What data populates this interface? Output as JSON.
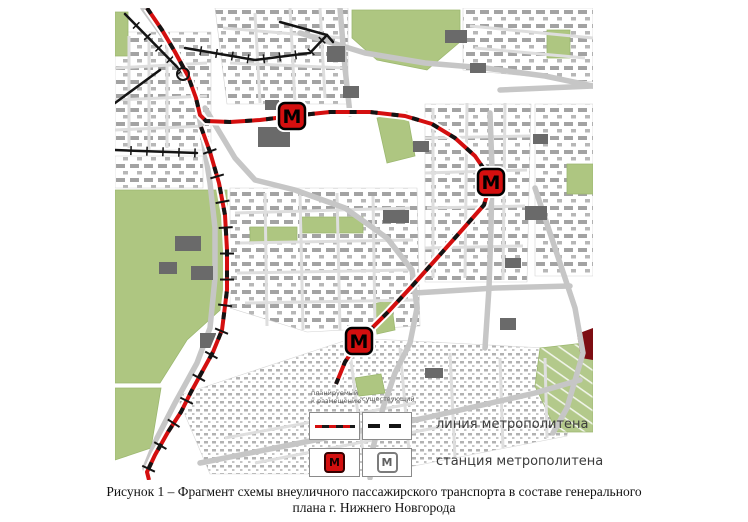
{
  "figure": {
    "caption_line1": "Рисунок 1 – Фрагмент схемы внеуличного пассажирского транспорта в составе генерального",
    "caption_line2": "плана г. Нижнего Новгорода"
  },
  "legend": {
    "header1_line1": "планируемый",
    "header1_line2": "к размещению",
    "header2": "существующий",
    "row1_label": "линия метрополитена",
    "row2_label": "станция метрополитена",
    "station_letter": "М"
  },
  "colors": {
    "metro_red": "#d40f0f",
    "line_black": "#141414",
    "park_green": "#aec681",
    "allotment_green": "#b3c98b",
    "road_gray": "#c6c6c6",
    "minor_road_gray": "#dedede",
    "dark_building": "#6a6a6a",
    "dark_red_area": "#7d0d12"
  },
  "map": {
    "stations_planned": [
      [
        177,
        108
      ],
      [
        376,
        174
      ],
      [
        244,
        333
      ]
    ],
    "metro_line_planned": [
      [
        32,
        0
      ],
      [
        47,
        22
      ],
      [
        60,
        44
      ],
      [
        73,
        68
      ],
      [
        81,
        90
      ],
      [
        85,
        107
      ],
      [
        91,
        113
      ],
      [
        115,
        114
      ],
      [
        145,
        112
      ],
      [
        177,
        108
      ],
      [
        215,
        104
      ],
      [
        255,
        104
      ],
      [
        290,
        108
      ],
      [
        317,
        116
      ],
      [
        340,
        130
      ],
      [
        360,
        148
      ],
      [
        369,
        161
      ],
      [
        376,
        174
      ],
      [
        369,
        197
      ],
      [
        347,
        222
      ],
      [
        323,
        249
      ],
      [
        298,
        277
      ],
      [
        273,
        304
      ],
      [
        244,
        333
      ],
      [
        230,
        354
      ],
      [
        221,
        376
      ]
    ],
    "railway_red": [
      [
        86,
        119
      ],
      [
        95,
        144
      ],
      [
        104,
        175
      ],
      [
        110,
        207
      ],
      [
        112,
        242
      ],
      [
        112,
        282
      ],
      [
        107,
        322
      ],
      [
        98,
        344
      ],
      [
        87,
        364
      ],
      [
        76,
        384
      ],
      [
        66,
        404
      ],
      [
        53,
        424
      ],
      [
        40,
        447
      ],
      [
        32,
        464
      ],
      [
        34,
        472
      ]
    ],
    "railways_black": [
      {
        "pts": [
          [
            10,
            6
          ],
          [
            71,
            68
          ]
        ],
        "ticks": true
      },
      {
        "pts": [
          [
            0,
            142
          ],
          [
            82,
            145
          ]
        ],
        "ticks": true
      },
      {
        "pts": [
          [
            45,
            62
          ],
          [
            0,
            95
          ]
        ],
        "ticks": false
      },
      {
        "pts": [
          [
            70,
            40
          ],
          [
            140,
            52
          ],
          [
            195,
            45
          ],
          [
            212,
            27
          ]
        ],
        "ticks": true
      },
      {
        "pts": [
          [
            165,
            14
          ],
          [
            212,
            27
          ],
          [
            218,
            34
          ]
        ],
        "ticks": false
      }
    ],
    "junction_circle": [
      68,
      66,
      6
    ],
    "parks": [
      [
        [
          0,
          4
        ],
        [
          13,
          4
        ],
        [
          13,
          48
        ],
        [
          0,
          48
        ]
      ],
      [
        [
          237,
          2
        ],
        [
          345,
          2
        ],
        [
          345,
          34
        ],
        [
          312,
          62
        ],
        [
          262,
          52
        ],
        [
          237,
          30
        ]
      ],
      [
        [
          432,
          22
        ],
        [
          455,
          22
        ],
        [
          455,
          50
        ],
        [
          432,
          50
        ]
      ],
      [
        [
          452,
          156
        ],
        [
          478,
          156
        ],
        [
          478,
          186
        ],
        [
          452,
          186
        ]
      ],
      [
        [
          0,
          182
        ],
        [
          112,
          182
        ],
        [
          113,
          295
        ],
        [
          72,
          332
        ],
        [
          45,
          375
        ],
        [
          0,
          375
        ]
      ],
      [
        [
          0,
          380
        ],
        [
          46,
          380
        ],
        [
          36,
          440
        ],
        [
          0,
          452
        ]
      ],
      [
        [
          135,
          219
        ],
        [
          182,
          219
        ],
        [
          182,
          234
        ],
        [
          135,
          234
        ]
      ],
      [
        [
          187,
          209
        ],
        [
          248,
          209
        ],
        [
          248,
          225
        ],
        [
          187,
          225
        ]
      ],
      [
        [
          262,
          110
        ],
        [
          292,
          104
        ],
        [
          300,
          148
        ],
        [
          272,
          155
        ]
      ],
      [
        [
          258,
          296
        ],
        [
          276,
          292
        ],
        [
          280,
          322
        ],
        [
          262,
          326
        ]
      ],
      [
        [
          240,
          370
        ],
        [
          266,
          366
        ],
        [
          270,
          385
        ],
        [
          244,
          388
        ]
      ]
    ],
    "allotment": [
      [
        425,
        340
      ],
      [
        478,
        334
      ],
      [
        478,
        424
      ],
      [
        442,
        424
      ],
      [
        420,
        378
      ]
    ],
    "dark_red_poly": [
      [
        462,
        326
      ],
      [
        478,
        320
      ],
      [
        478,
        352
      ],
      [
        466,
        350
      ]
    ],
    "fabric_coarse": [
      [
        [
          0,
          24
        ],
        [
          96,
          24
        ],
        [
          96,
          142
        ],
        [
          0,
          142
        ]
      ],
      [
        [
          100,
          0
        ],
        [
          233,
          0
        ],
        [
          233,
          96
        ],
        [
          112,
          96
        ]
      ],
      [
        [
          348,
          0
        ],
        [
          478,
          0
        ],
        [
          478,
          74
        ],
        [
          348,
          62
        ]
      ],
      [
        [
          420,
          96
        ],
        [
          478,
          96
        ],
        [
          478,
          268
        ],
        [
          420,
          268
        ]
      ],
      [
        [
          115,
          180
        ],
        [
          302,
          180
        ],
        [
          305,
          318
        ],
        [
          192,
          324
        ],
        [
          115,
          300
        ]
      ],
      [
        [
          310,
          96
        ],
        [
          416,
          96
        ],
        [
          412,
          274
        ],
        [
          310,
          274
        ]
      ],
      [
        [
          0,
          148
        ],
        [
          88,
          148
        ],
        [
          88,
          180
        ],
        [
          0,
          180
        ]
      ]
    ],
    "fabric_fine": [
      [
        [
          62,
          388
        ],
        [
          238,
          330
        ],
        [
          470,
          342
        ],
        [
          452,
          428
        ],
        [
          258,
          466
        ],
        [
          95,
          466
        ]
      ]
    ],
    "roads_major": [
      [
        [
          185,
          25
        ],
        [
          250,
          45
        ],
        [
          310,
          55
        ],
        [
          370,
          60
        ],
        [
          430,
          68
        ],
        [
          478,
          78
        ]
      ],
      [
        [
          28,
          0
        ],
        [
          60,
          44
        ],
        [
          81,
          90
        ],
        [
          88,
          130
        ],
        [
          95,
          175
        ],
        [
          100,
          220
        ],
        [
          100,
          270
        ],
        [
          95,
          320
        ],
        [
          82,
          355
        ],
        [
          60,
          395
        ],
        [
          42,
          430
        ],
        [
          30,
          460
        ],
        [
          33,
          472
        ]
      ],
      [
        [
          90,
          100
        ],
        [
          120,
          150
        ],
        [
          140,
          172
        ],
        [
          180,
          182
        ],
        [
          230,
          200
        ],
        [
          272,
          230
        ],
        [
          297,
          262
        ],
        [
          302,
          300
        ],
        [
          295,
          335
        ],
        [
          280,
          365
        ],
        [
          268,
          400
        ],
        [
          258,
          440
        ],
        [
          255,
          470
        ]
      ],
      [
        [
          375,
          105
        ],
        [
          377,
          160
        ],
        [
          376,
          220
        ],
        [
          374,
          280
        ],
        [
          370,
          340
        ]
      ],
      [
        [
          420,
          180
        ],
        [
          440,
          240
        ],
        [
          460,
          300
        ],
        [
          468,
          345
        ],
        [
          452,
          400
        ],
        [
          438,
          425
        ]
      ],
      [
        [
          300,
          285
        ],
        [
          380,
          280
        ],
        [
          455,
          278
        ]
      ],
      [
        [
          385,
          82
        ],
        [
          478,
          78
        ]
      ],
      [
        [
          85,
          455
        ],
        [
          200,
          432
        ],
        [
          310,
          410
        ],
        [
          420,
          385
        ],
        [
          465,
          372
        ]
      ],
      [
        [
          225,
          0
        ],
        [
          230,
          60
        ],
        [
          235,
          106
        ]
      ]
    ],
    "roads_minor": [
      [
        [
          14,
          28
        ],
        [
          14,
          140
        ]
      ],
      [
        [
          34,
          26
        ],
        [
          34,
          142
        ]
      ],
      [
        [
          52,
          30
        ],
        [
          52,
          140
        ]
      ],
      [
        [
          0,
          60
        ],
        [
          92,
          55
        ]
      ],
      [
        [
          0,
          92
        ],
        [
          92,
          88
        ]
      ],
      [
        [
          0,
          122
        ],
        [
          90,
          118
        ]
      ],
      [
        [
          108,
          20
        ],
        [
          228,
          30
        ]
      ],
      [
        [
          115,
          55
        ],
        [
          230,
          60
        ]
      ],
      [
        [
          140,
          5
        ],
        [
          145,
          95
        ]
      ],
      [
        [
          175,
          0
        ],
        [
          180,
          95
        ]
      ],
      [
        [
          205,
          0
        ],
        [
          210,
          90
        ]
      ],
      [
        [
          318,
          100
        ],
        [
          318,
          270
        ]
      ],
      [
        [
          352,
          95
        ],
        [
          350,
          270
        ]
      ],
      [
        [
          390,
          95
        ],
        [
          388,
          272
        ]
      ],
      [
        [
          310,
          130
        ],
        [
          415,
          128
        ]
      ],
      [
        [
          310,
          165
        ],
        [
          412,
          162
        ]
      ],
      [
        [
          312,
          200
        ],
        [
          410,
          198
        ]
      ],
      [
        [
          310,
          240
        ],
        [
          408,
          238
        ]
      ],
      [
        [
          120,
          205
        ],
        [
          295,
          200
        ]
      ],
      [
        [
          125,
          235
        ],
        [
          298,
          232
        ]
      ],
      [
        [
          122,
          265
        ],
        [
          296,
          262
        ]
      ],
      [
        [
          130,
          295
        ],
        [
          300,
          292
        ]
      ],
      [
        [
          150,
          185
        ],
        [
          152,
          318
        ]
      ],
      [
        [
          185,
          185
        ],
        [
          188,
          322
        ]
      ],
      [
        [
          222,
          185
        ],
        [
          225,
          322
        ]
      ],
      [
        [
          258,
          188
        ],
        [
          260,
          320
        ]
      ],
      [
        [
          110,
          430
        ],
        [
          300,
          395
        ]
      ],
      [
        [
          140,
          455
        ],
        [
          330,
          418
        ]
      ],
      [
        [
          235,
          345
        ],
        [
          250,
          460
        ]
      ],
      [
        [
          285,
          340
        ],
        [
          295,
          455
        ]
      ],
      [
        [
          335,
          345
        ],
        [
          340,
          450
        ]
      ],
      [
        [
          385,
          350
        ],
        [
          388,
          440
        ]
      ],
      [
        [
          430,
          350
        ],
        [
          432,
          430
        ]
      ],
      [
        [
          355,
          18
        ],
        [
          478,
          30
        ]
      ],
      [
        [
          360,
          40
        ],
        [
          470,
          50
        ]
      ]
    ],
    "dark_buildings": [
      [
        143,
        119,
        32,
        20
      ],
      [
        212,
        38,
        18,
        16
      ],
      [
        228,
        78,
        16,
        12
      ],
      [
        330,
        22,
        22,
        13
      ],
      [
        268,
        202,
        26,
        13
      ],
      [
        410,
        198,
        22,
        14
      ],
      [
        60,
        228,
        26,
        15
      ],
      [
        44,
        254,
        18,
        12
      ],
      [
        76,
        258,
        22,
        14
      ],
      [
        150,
        92,
        14,
        10
      ],
      [
        418,
        126,
        15,
        10
      ],
      [
        298,
        133,
        16,
        11
      ],
      [
        85,
        325,
        16,
        15
      ],
      [
        310,
        360,
        18,
        10
      ],
      [
        355,
        55,
        16,
        10
      ],
      [
        390,
        250,
        16,
        10
      ],
      [
        385,
        310,
        16,
        12
      ]
    ]
  }
}
